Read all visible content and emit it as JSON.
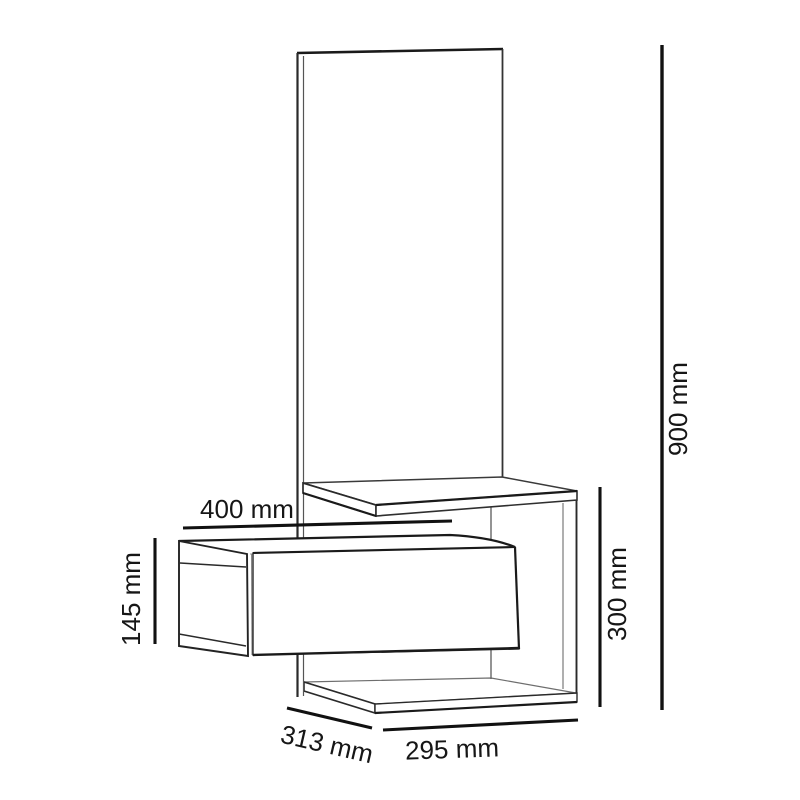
{
  "title": "Wall-mounted dresser technical drawing",
  "dimensions": {
    "top_width": {
      "label": "400 mm"
    },
    "drawer_height": {
      "label": "145 mm"
    },
    "overall_height": {
      "label": "900 mm"
    },
    "right_section_height": {
      "label": "300 mm"
    },
    "depth": {
      "label": "313 mm"
    },
    "bottom_width": {
      "label": "295 mm"
    }
  },
  "colors": {
    "background": "#ffffff",
    "line_heavy": "#1a1a1a",
    "line_medium": "#3a3a3a",
    "line_light": "#8a8a8a",
    "text": "#161616"
  }
}
